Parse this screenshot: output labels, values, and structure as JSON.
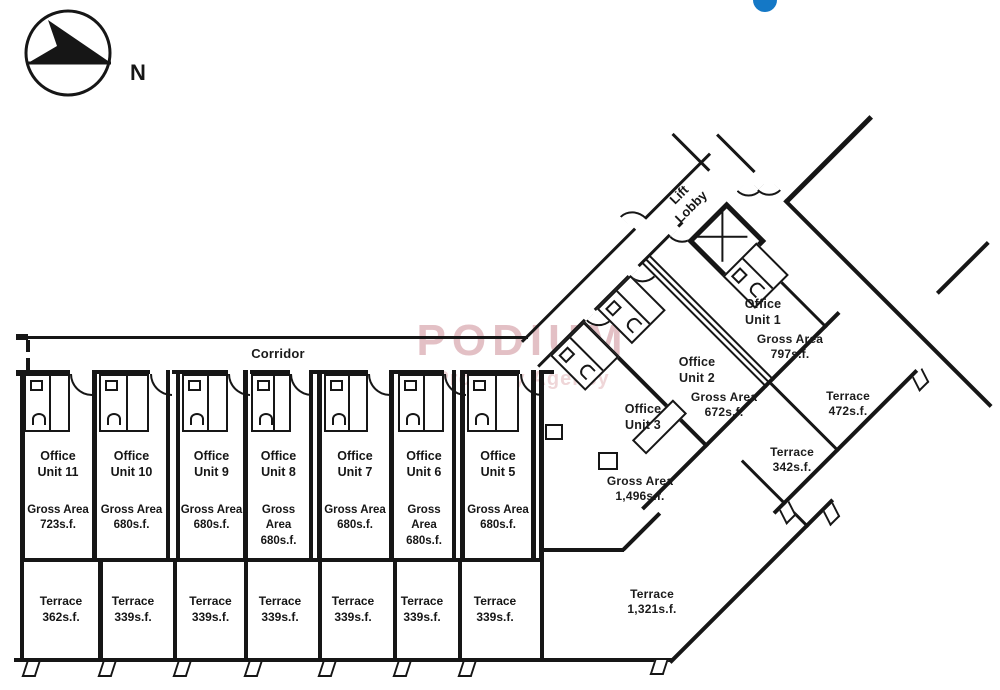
{
  "compass": {
    "label": "N"
  },
  "watermark": {
    "line1": "PODIUM",
    "line2": "Property Agency"
  },
  "corridor": {
    "label": "Corridor"
  },
  "wing": {
    "lobby": {
      "l1": "Lift",
      "l2": "Lobby"
    },
    "u1": {
      "l1": "Office",
      "l2": "Unit 1"
    },
    "g1": {
      "l1": "Gross Area",
      "l2": "797s.f."
    },
    "u2": {
      "l1": "Office",
      "l2": "Unit 2"
    },
    "g2": {
      "l1": "Gross Area",
      "l2": "672s.f."
    },
    "u3": {
      "l1": "Office",
      "l2": "Unit 3"
    },
    "g3": {
      "l1": "Gross Area",
      "l2": "1,496s.f."
    },
    "t472": {
      "l1": "Terrace",
      "l2": "472s.f."
    },
    "t342": {
      "l1": "Terrace",
      "l2": "342s.f."
    },
    "t1321": {
      "l1": "Terrace",
      "l2": "1,321s.f."
    }
  },
  "units": [
    {
      "l1": "Office",
      "l2": "Unit 11",
      "a1": "Gross Area",
      "a2": "723s.f."
    },
    {
      "l1": "Office",
      "l2": "Unit 10",
      "a1": "Gross Area",
      "a2": "680s.f."
    },
    {
      "l1": "Office",
      "l2": "Unit 9",
      "a1": "Gross Area",
      "a2": "680s.f."
    },
    {
      "l1": "Office",
      "l2": "Unit 8",
      "a1": "Gross Area",
      "a2": "680s.f."
    },
    {
      "l1": "Office",
      "l2": "Unit 7",
      "a1": "Gross Area",
      "a2": "680s.f."
    },
    {
      "l1": "Office",
      "l2": "Unit 6",
      "a1": "Gross Area",
      "a2": "680s.f."
    },
    {
      "l1": "Office",
      "l2": "Unit 5",
      "a1": "Gross Area",
      "a2": "680s.f."
    }
  ],
  "terraces": [
    {
      "l1": "Terrace",
      "l2": "362s.f."
    },
    {
      "l1": "Terrace",
      "l2": "339s.f."
    },
    {
      "l1": "Terrace",
      "l2": "339s.f."
    },
    {
      "l1": "Terrace",
      "l2": "339s.f."
    },
    {
      "l1": "Terrace",
      "l2": "339s.f."
    },
    {
      "l1": "Terrace",
      "l2": "339s.f."
    },
    {
      "l1": "Terrace",
      "l2": "339s.f."
    }
  ],
  "colors": {
    "ink": "#161616",
    "dot": "#1478c6",
    "wm1": "#e3c0c5",
    "wm2": "#efd6d8"
  }
}
